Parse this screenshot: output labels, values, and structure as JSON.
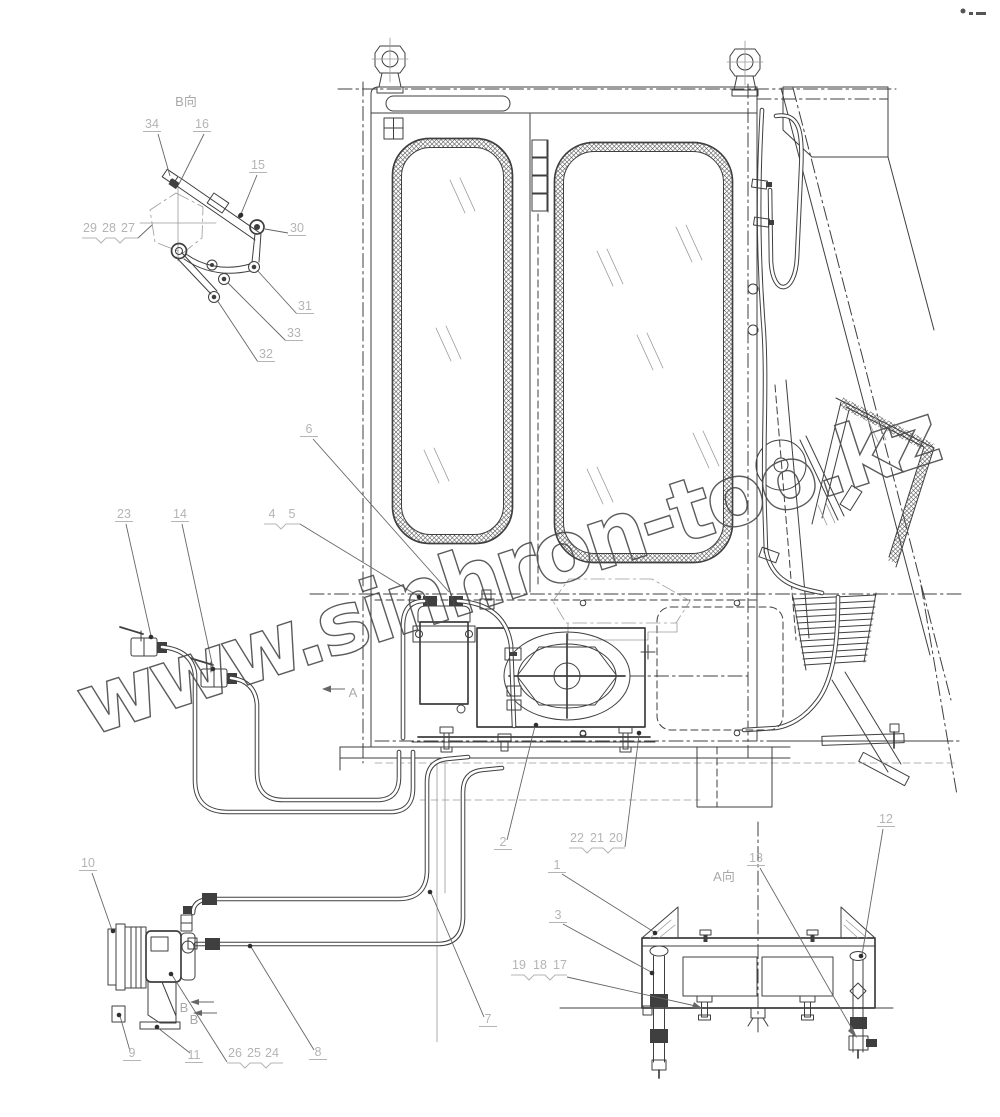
{
  "watermark": {
    "text": "www.sinhron-too.kz",
    "color": "#4a4a4a"
  },
  "drawing": {
    "type": "technical-assembly-drawing",
    "subject": "cab air-conditioning installation",
    "line_color": "#3f3f3f",
    "callout_color": "#b4b4b4"
  },
  "views": [
    {
      "label": "B向",
      "x": 186,
      "y": 106
    },
    {
      "label": "A向",
      "x": 724,
      "y": 881
    },
    {
      "label": "A",
      "x": 353,
      "y": 697
    },
    {
      "label": "B",
      "x": 184,
      "y": 1012
    },
    {
      "label": "B",
      "x": 194,
      "y": 1024
    }
  ],
  "callouts": [
    {
      "n": "34",
      "x": 152,
      "y": 128
    },
    {
      "n": "16",
      "x": 202,
      "y": 128
    },
    {
      "n": "15",
      "x": 258,
      "y": 169
    },
    {
      "n": "30",
      "x": 297,
      "y": 232
    },
    {
      "n": "29",
      "x": 90,
      "y": 232,
      "u": false
    },
    {
      "n": "28",
      "x": 109,
      "y": 232,
      "u": false
    },
    {
      "n": "27",
      "x": 128,
      "y": 232,
      "u": false
    },
    {
      "n": "31",
      "x": 305,
      "y": 310
    },
    {
      "n": "33",
      "x": 294,
      "y": 337
    },
    {
      "n": "32",
      "x": 266,
      "y": 358
    },
    {
      "n": "23",
      "x": 124,
      "y": 518
    },
    {
      "n": "14",
      "x": 180,
      "y": 518
    },
    {
      "n": "4",
      "x": 272,
      "y": 518,
      "u": false
    },
    {
      "n": "5",
      "x": 292,
      "y": 518,
      "u": false
    },
    {
      "n": "6",
      "x": 309,
      "y": 433
    },
    {
      "n": "10",
      "x": 88,
      "y": 867
    },
    {
      "n": "9",
      "x": 132,
      "y": 1057
    },
    {
      "n": "11",
      "x": 194,
      "y": 1059
    },
    {
      "n": "26",
      "x": 235,
      "y": 1057,
      "u": false
    },
    {
      "n": "25",
      "x": 254,
      "y": 1057,
      "u": false
    },
    {
      "n": "24",
      "x": 272,
      "y": 1057,
      "u": false
    },
    {
      "n": "8",
      "x": 318,
      "y": 1056
    },
    {
      "n": "7",
      "x": 488,
      "y": 1023
    },
    {
      "n": "2",
      "x": 503,
      "y": 846
    },
    {
      "n": "22",
      "x": 577,
      "y": 842,
      "u": false
    },
    {
      "n": "21",
      "x": 597,
      "y": 842,
      "u": false
    },
    {
      "n": "20",
      "x": 616,
      "y": 842,
      "u": false
    },
    {
      "n": "1",
      "x": 557,
      "y": 869
    },
    {
      "n": "3",
      "x": 558,
      "y": 919
    },
    {
      "n": "13",
      "x": 756,
      "y": 862
    },
    {
      "n": "12",
      "x": 886,
      "y": 823
    },
    {
      "n": "19",
      "x": 519,
      "y": 969,
      "u": false
    },
    {
      "n": "18",
      "x": 540,
      "y": 969,
      "u": false
    },
    {
      "n": "17",
      "x": 560,
      "y": 969,
      "u": false
    }
  ]
}
